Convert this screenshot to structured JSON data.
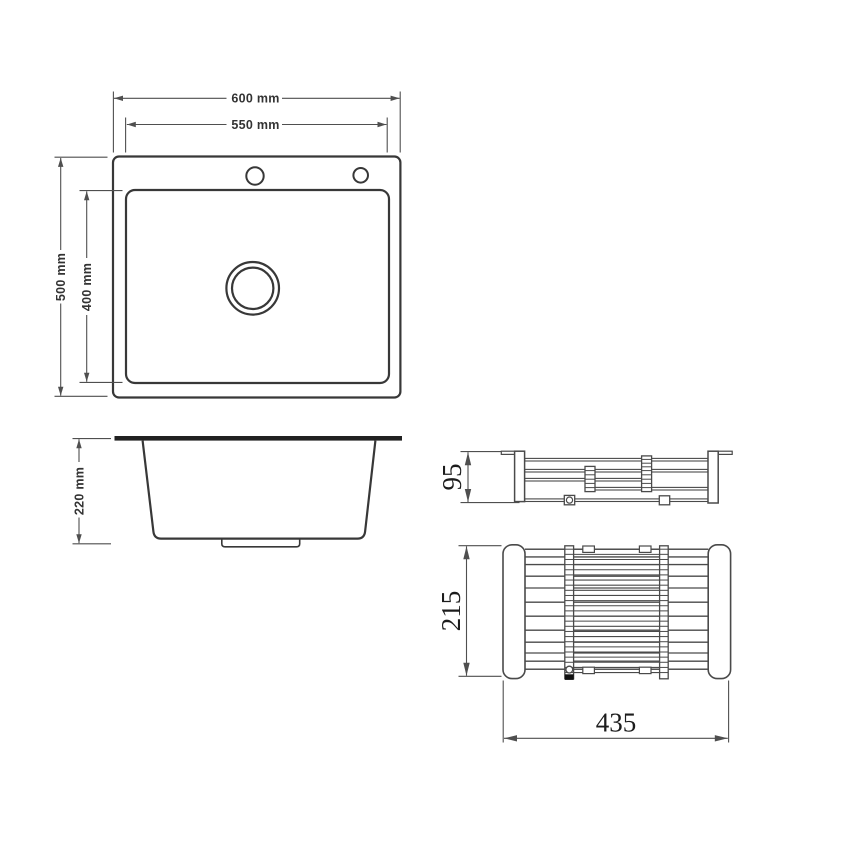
{
  "drawing": {
    "sink_top_view": {
      "width_outer": "600 mm",
      "width_inner": "550 mm",
      "height_outer": "500 mm",
      "height_inner": "400 mm"
    },
    "sink_side_view": {
      "depth": "220 mm"
    },
    "rack_side_view": {
      "height": "95"
    },
    "rack_top_view": {
      "depth": "215",
      "width": "435"
    },
    "colors": {
      "sink_line": "#383838",
      "rack_line": "#4a4a4a",
      "dim_line": "#4f4f4f",
      "text_sans": "#333333",
      "text_serif": "#1c1c1c",
      "bar_fill": "#212121"
    }
  }
}
